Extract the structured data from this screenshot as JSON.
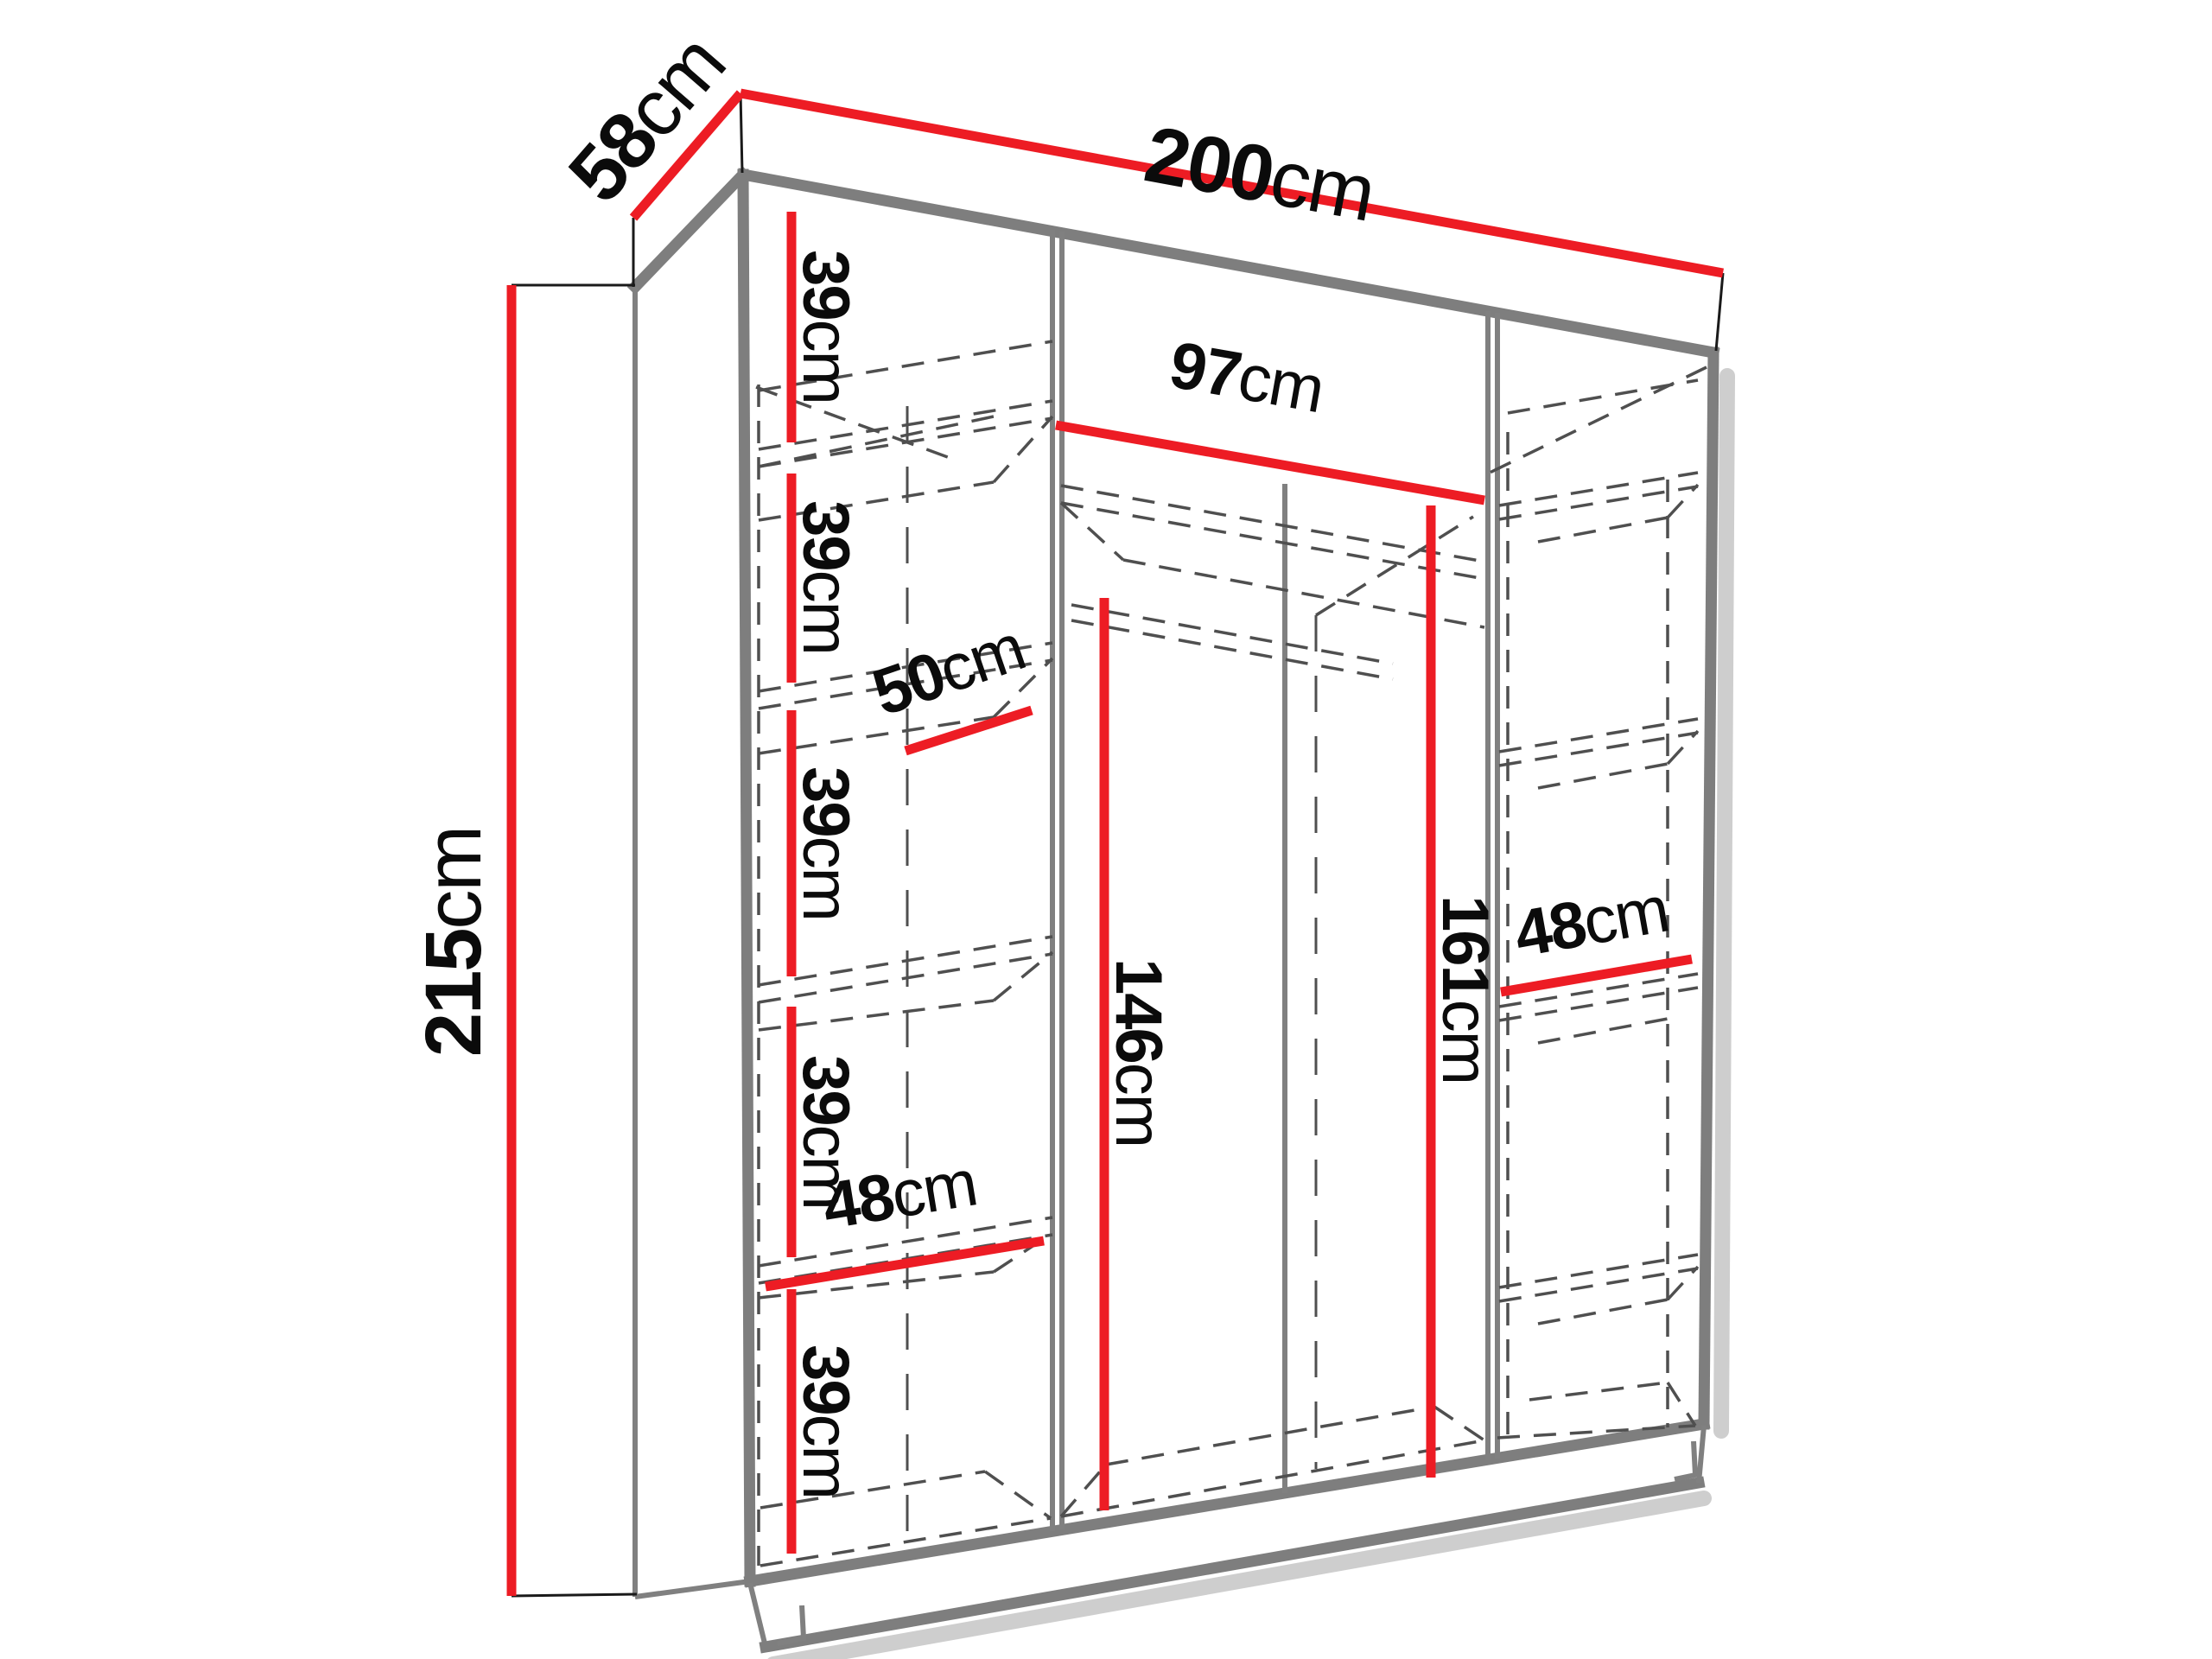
{
  "diagram": {
    "kind": "wardrobe-dimension-diagram",
    "unit": "cm",
    "accent_color": "#ed1c24",
    "structure_color": "#7e7e7e",
    "hidden_line_color": "#4f4f4f",
    "text_color": "#0b0b0b",
    "background": "#ffffff"
  },
  "dims": {
    "depth": {
      "v": "58",
      "u": "cm"
    },
    "width": {
      "v": "200",
      "u": "cm"
    },
    "height": {
      "v": "215",
      "u": "cm"
    },
    "gap1": {
      "v": "39",
      "u": "cm"
    },
    "gap2": {
      "v": "39",
      "u": "cm"
    },
    "gap3": {
      "v": "39",
      "u": "cm"
    },
    "gap4": {
      "v": "39",
      "u": "cm"
    },
    "gap5": {
      "v": "39",
      "u": "cm"
    },
    "shelf_depth": {
      "v": "50",
      "u": "cm"
    },
    "mid_width": {
      "v": "97",
      "u": "cm"
    },
    "rod_height": {
      "v": "146",
      "u": "cm"
    },
    "mid_height": {
      "v": "161",
      "u": "cm"
    },
    "left_width": {
      "v": "48",
      "u": "cm"
    },
    "right_width": {
      "v": "48",
      "u": "cm"
    }
  }
}
